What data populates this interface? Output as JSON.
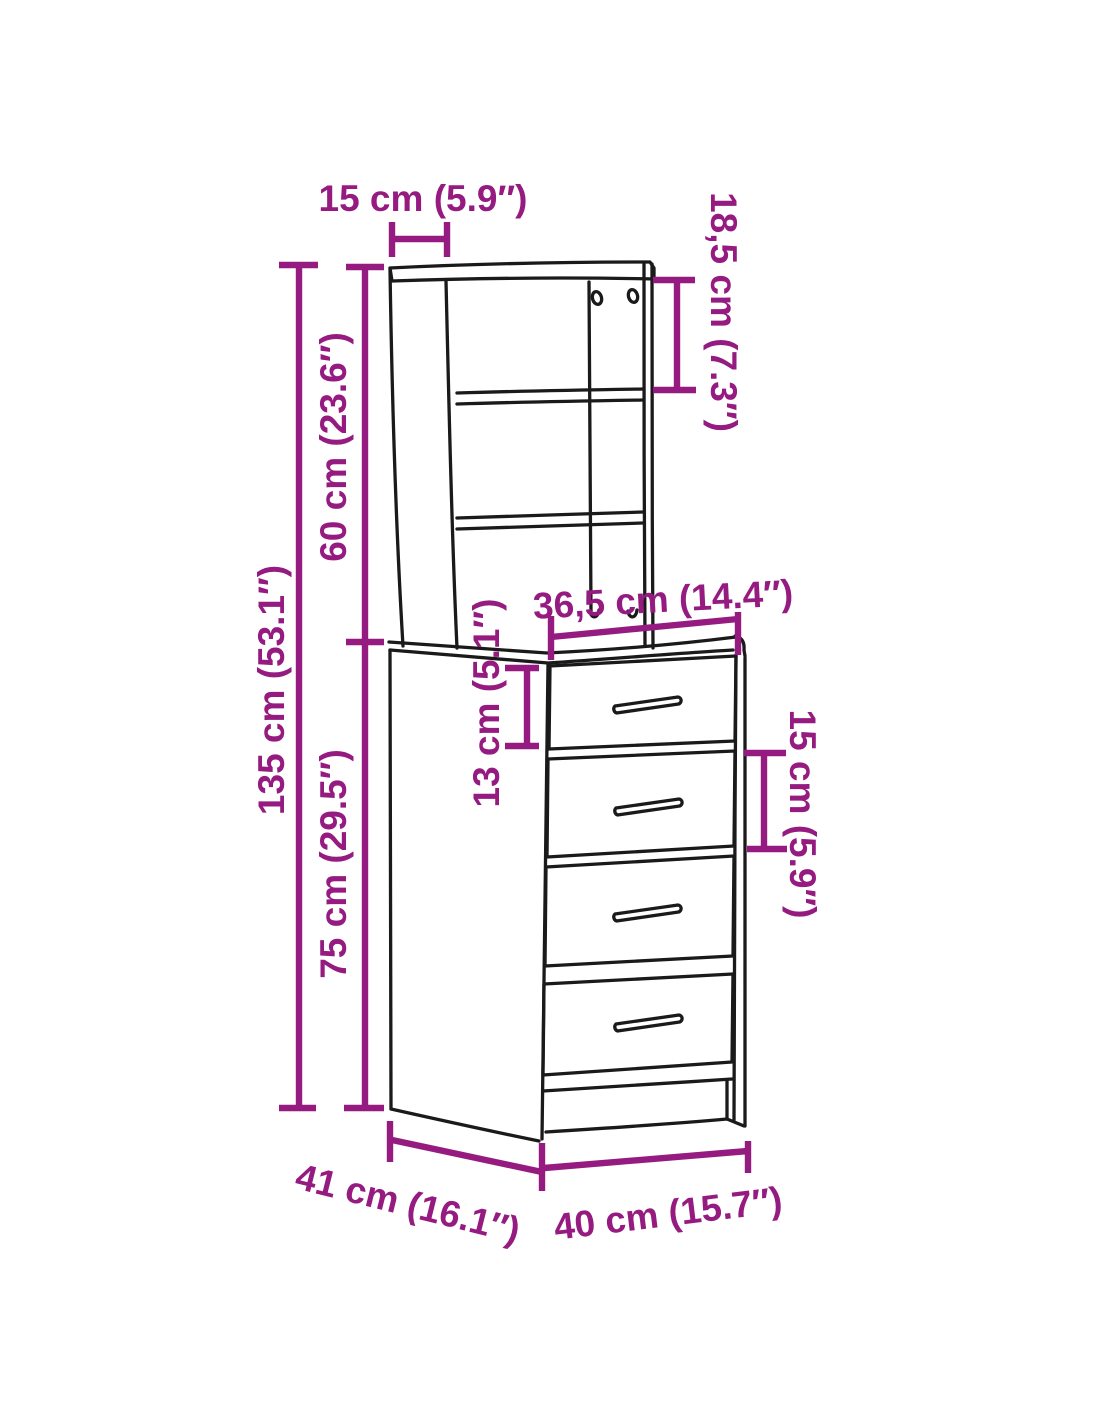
{
  "diagram": {
    "subject": "highboard-cabinet-with-shelf-hutch-and-4-drawers",
    "background_color": "#ffffff",
    "outline_color": "#1a1a1a",
    "accent_color": "#951B81",
    "dimensions": {
      "hutch_depth_top": "15 cm (5.9″)",
      "shelf_compartment_height": "18,5 cm (7.3″)",
      "hutch_height": "60 cm (23.6″)",
      "total_height": "135 cm (53.1″)",
      "drawer_front_width": "36,5 cm (14.4″)",
      "top_drawer_height": "13 cm (5.1″)",
      "drawer_pitch": "15 cm (5.9″)",
      "base_unit_height": "75 cm (29.5″)",
      "depth": "41 cm (16.1″)",
      "width": "40 cm (15.7″)"
    },
    "units": [
      "cm",
      "inches"
    ]
  }
}
